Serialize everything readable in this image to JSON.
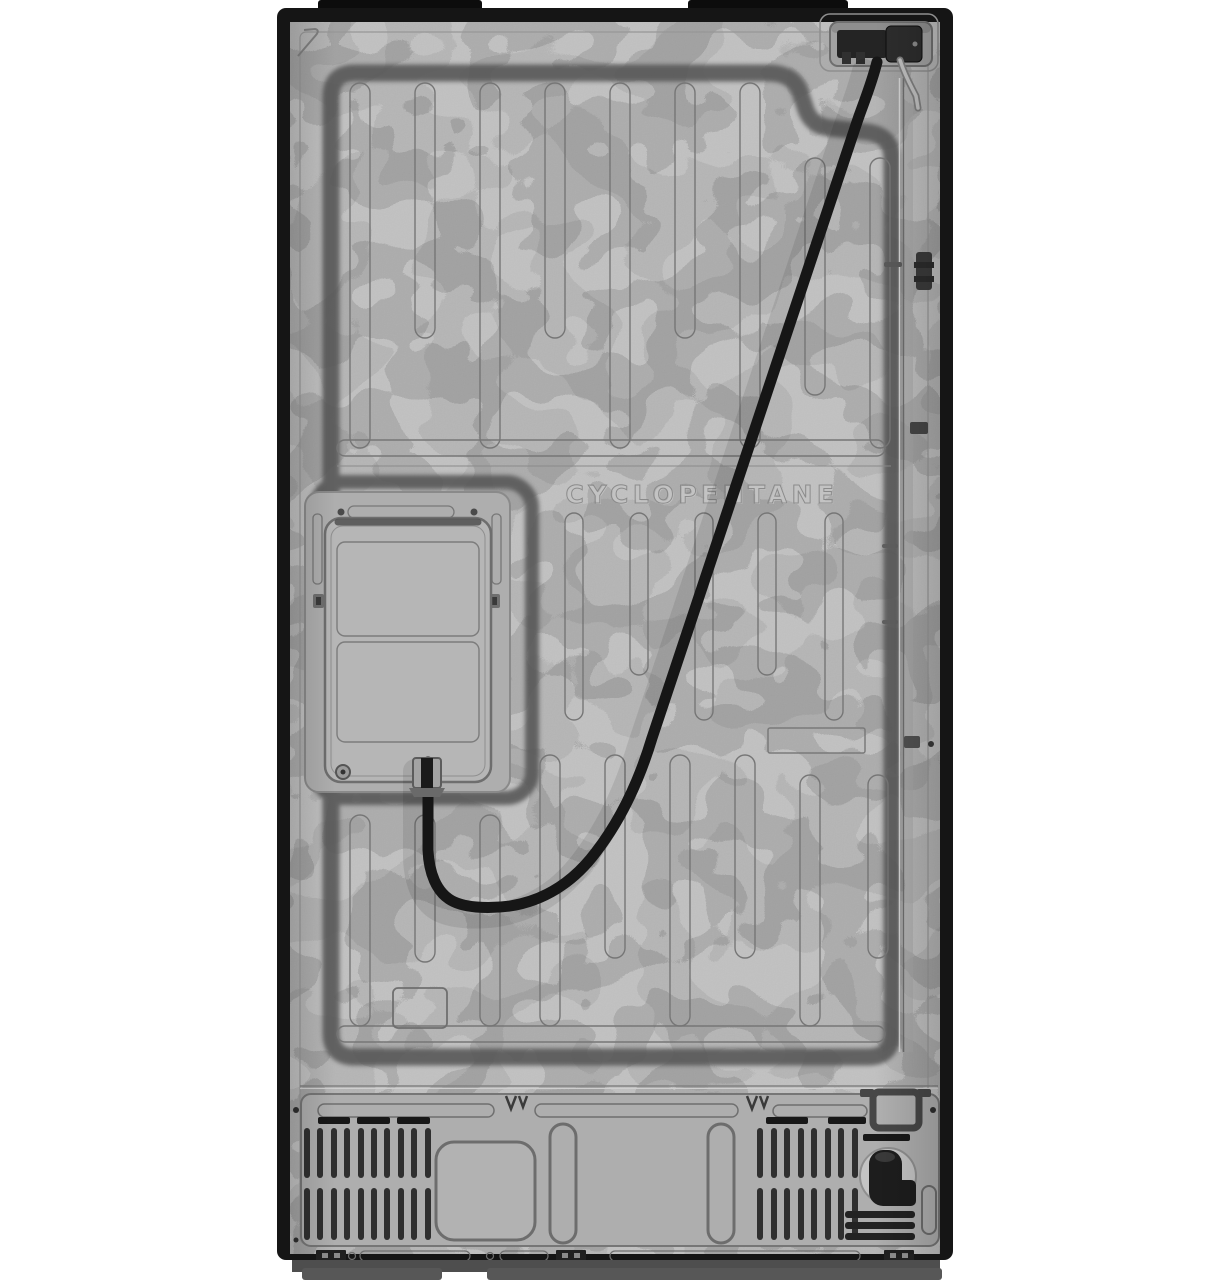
{
  "panel": {
    "embossed_label": "CYCLOPENTANE"
  },
  "colors": {
    "background": "#ffffff",
    "frame_black": "#141414",
    "steel": "#b5b5b5",
    "steel_recess": "#aeaeae",
    "groove_shadow": "#575757",
    "emboss_line": "#767676",
    "power_cord": "#161616",
    "vent_slat": "#2f2f2f"
  },
  "parts": {
    "power_inlet": "power-cord-connector",
    "power_cord": "power-cord",
    "access_panel": "rear-access-panel",
    "vents": "ventilation-grilles",
    "water_valve": "water-inlet-valve",
    "label_area": "label-recess"
  }
}
